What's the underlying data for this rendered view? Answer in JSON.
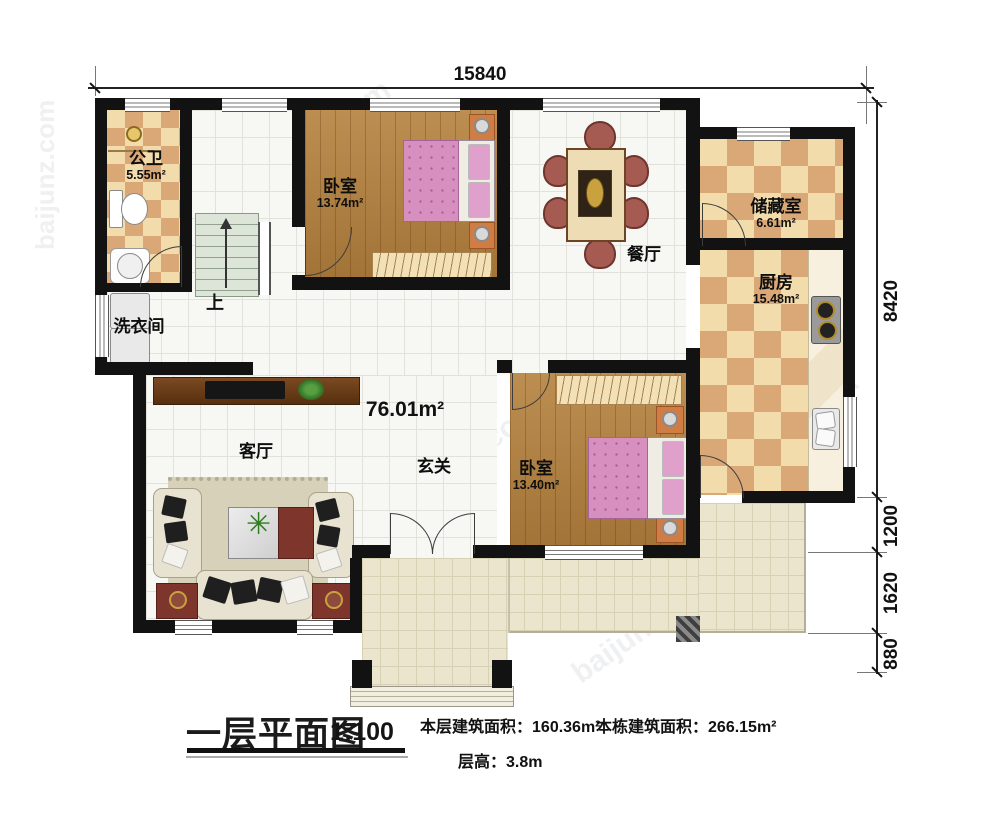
{
  "dimensions": {
    "top": "15840",
    "right": [
      "8420",
      "1200",
      "1620",
      "880"
    ]
  },
  "open_area": "76.01m²",
  "stairs_label": "上",
  "rooms": {
    "bathroom": {
      "name": "公卫",
      "area": "5.55m²"
    },
    "laundry": {
      "name": "洗衣间"
    },
    "bedroom1": {
      "name": "卧室",
      "area": "13.74m²"
    },
    "dining": {
      "name": "餐厅"
    },
    "storage": {
      "name": "储藏室",
      "area": "6.61m²"
    },
    "kitchen": {
      "name": "厨房",
      "area": "15.48m²"
    },
    "living": {
      "name": "客厅"
    },
    "foyer": {
      "name": "玄关"
    },
    "bedroom2": {
      "name": "卧室",
      "area": "13.40m²"
    }
  },
  "title_block": {
    "plan_name": "一层平面图",
    "scale": "1:100",
    "floor_area_label": "本层建筑面积：",
    "floor_area_value": "160.36m²",
    "total_area_label": "本栋建筑面积：",
    "total_area_value": "266.15m²",
    "floor_height_label": "层高：",
    "floor_height_value": "3.8m"
  },
  "watermark": {
    "text": "baijunz.com"
  },
  "colors": {
    "wall": "#121212",
    "checker_dark": "#d9a876",
    "checker_light": "#f3dcab",
    "wood_floor": "#b5813d",
    "tile_floor": "#f7f7f4",
    "terrace_floor": "#ebe5cd",
    "bed_pink": "#d78fc0",
    "chair_red": "#a65b52"
  }
}
